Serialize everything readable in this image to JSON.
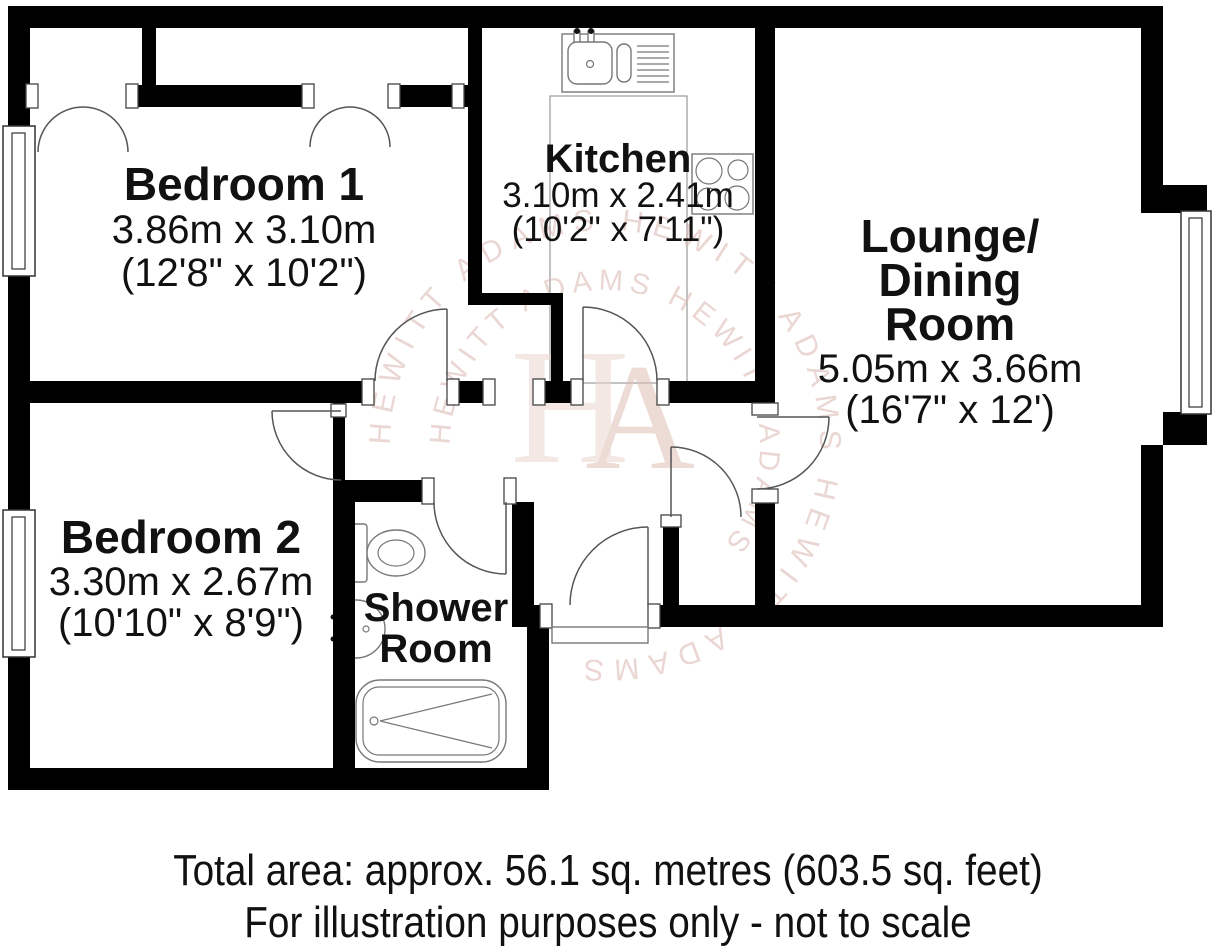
{
  "rooms": {
    "bedroom1": {
      "name": "Bedroom 1",
      "metric": "3.86m x 3.10m",
      "imperial": "(12'8\" x 10'2\")"
    },
    "kitchen": {
      "name": "Kitchen",
      "metric": "3.10m x 2.41m",
      "imperial": "(10'2\" x 7'11\")"
    },
    "lounge": {
      "name_line1": "Lounge/",
      "name_line2": "Dining",
      "name_line3": "Room",
      "metric": "5.05m x 3.66m",
      "imperial": "(16'7\" x 12')"
    },
    "bedroom2": {
      "name": "Bedroom 2",
      "metric": "3.30m x 2.67m",
      "imperial": "(10'10\" x 8'9\")"
    },
    "shower": {
      "name_line1": "Shower",
      "name_line2": "Room"
    }
  },
  "watermark": {
    "initial_h": "H",
    "initial_a": "A",
    "brand": "HEWITT ADAMS",
    "ring_outer": "HEWITT ADAMS        HEWITT ADAMS        HEWITT ADAMS",
    "ring_inner": "HEWITT ADAMS        HEWITT ADAMS",
    "color": "#d9b6ae"
  },
  "fixtures": {
    "kitchen_sink": "sink with drainer",
    "hob": "4-ring hob",
    "toilet": "toilet",
    "basin": "wash basin",
    "bathtub": "bath"
  },
  "colors": {
    "wall": "#000000",
    "line": "#555555",
    "text": "#111111"
  },
  "footer": {
    "line1": "Total area: approx. 56.1 sq. metres (603.5 sq. feet)",
    "line2": "For illustration purposes only - not to scale"
  }
}
